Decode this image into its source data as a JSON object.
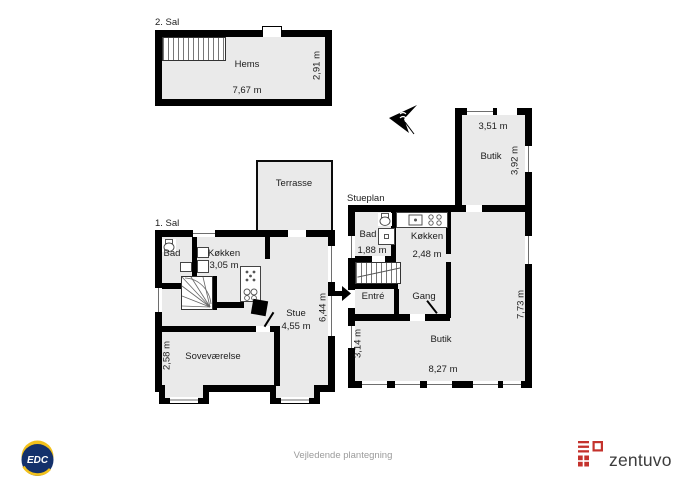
{
  "document": {
    "type": "floor-plan",
    "disclaimer": "Vejledende plantegning"
  },
  "colors": {
    "wall": "#000000",
    "floor_fill": "#eaeaea",
    "edc_navy": "#14316b",
    "edc_yellow": "#f2c11c",
    "zentuvo_red": "#c4322c",
    "disclaimer_gray": "#9b9b9b"
  },
  "second_floor": {
    "title": "2. Sal",
    "room": "Hems",
    "width_label": "7,67 m",
    "height_label": "2,91 m"
  },
  "first_floor": {
    "title": "1. Sal",
    "terrace": "Terrasse",
    "bath": "Bad",
    "kitchen": "Køkken",
    "kitchen_dim": "3,05 m",
    "living": "Stue",
    "living_dim": "4,55 m",
    "living_height": "6,44 m",
    "bedroom": "Soveværelse",
    "bedroom_dim": "2,58 m"
  },
  "ground_floor": {
    "title": "Stueplan",
    "bath": "Bad",
    "bath_dim": "1,88 m",
    "kitchen": "Køkken",
    "kitchen_dim": "2,48 m",
    "entry": "Entré",
    "hall": "Gang",
    "shop_top": "Butik",
    "shop_top_width": "3,51 m",
    "shop_top_height": "3,92 m",
    "shop_main": "Butik",
    "shop_main_width": "8,27 m",
    "shop_main_left_height": "3,14 m",
    "shop_main_right_height": "7,73 m"
  },
  "footer": {
    "edc": "EDC",
    "zentuvo": "zentuvo"
  }
}
